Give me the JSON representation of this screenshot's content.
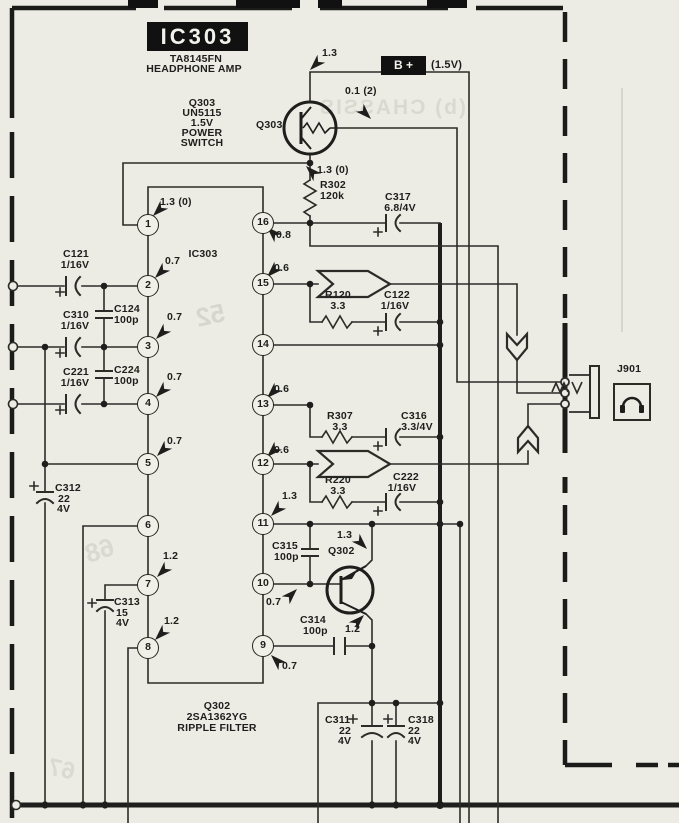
{
  "title_block": {
    "id": "IC303",
    "part": "TA8145FN",
    "function": "HEADPHONE AMP"
  },
  "power_rail": {
    "label": "B +",
    "note": "(1.5V)"
  },
  "transistors": {
    "q303": {
      "circle_label": "Q303",
      "lines": [
        "Q303",
        "UN5115",
        "1.5V",
        "POWER",
        "SWITCH"
      ]
    },
    "q302": {
      "circle_label": "Q302",
      "lines": [
        "Q302",
        "2SA1362YG",
        "RIPPLE FILTER"
      ]
    }
  },
  "ic": {
    "inner_label": "IC303",
    "pins": [
      "1",
      "2",
      "3",
      "4",
      "5",
      "6",
      "7",
      "8",
      "9",
      "10",
      "11",
      "12",
      "13",
      "14",
      "15",
      "16"
    ]
  },
  "components": {
    "r302": {
      "ref": "R302",
      "value": "120k"
    },
    "r120": {
      "ref": "R120",
      "value": "3.3"
    },
    "r307": {
      "ref": "R307",
      "value": "3.3"
    },
    "r220": {
      "ref": "R220",
      "value": "3.3"
    },
    "c121": {
      "ref": "C121",
      "value": "1/16V"
    },
    "c310": {
      "ref": "C310",
      "value": "1/16V"
    },
    "c221": {
      "ref": "C221",
      "value": "1/16V"
    },
    "c124": {
      "ref": "C124",
      "value": "100p"
    },
    "c224": {
      "ref": "C224",
      "value": "100p"
    },
    "c312": {
      "ref": "C312",
      "value": "22",
      "voltage": "4V"
    },
    "c313": {
      "ref": "C313",
      "value": "15",
      "voltage": "4V"
    },
    "c315": {
      "ref": "C315",
      "value": "100p"
    },
    "c314": {
      "ref": "C314",
      "value": "100p"
    },
    "c317": {
      "ref": "C317",
      "value": "6.8/4V"
    },
    "c122": {
      "ref": "C122",
      "value": "1/16V"
    },
    "c316": {
      "ref": "C316",
      "value": "3.3/4V"
    },
    "c222": {
      "ref": "C222",
      "value": "1/16V"
    },
    "c311": {
      "ref": "C311",
      "value": "22",
      "voltage": "4V"
    },
    "c318": {
      "ref": "C318",
      "value": "22",
      "voltage": "4V"
    }
  },
  "voltages": {
    "top": "1.3",
    "q303_out": "0.1  (2)",
    "q303_base": "1.3  (0)",
    "pin1": "1.3  (0)",
    "pin16": "0.8",
    "pin2": "0.7",
    "pin15": "0.6",
    "pin3": "0.7",
    "pin4": "0.7",
    "pin13": "0.6",
    "pin5": "0.7",
    "pin12": "0.6",
    "pin11": "1.3",
    "pin7": "1.2",
    "q302_collector": "1.3",
    "pin10": "0.7",
    "q302_emitter": "1.2",
    "pin8": "1.2",
    "pin9": "0.7"
  },
  "jack": {
    "ref": "J901"
  },
  "artifacts": {
    "bleed1": "(b) CHASSIS",
    "bleed2": "52",
    "bleed3": "68",
    "bleed4": "67"
  }
}
